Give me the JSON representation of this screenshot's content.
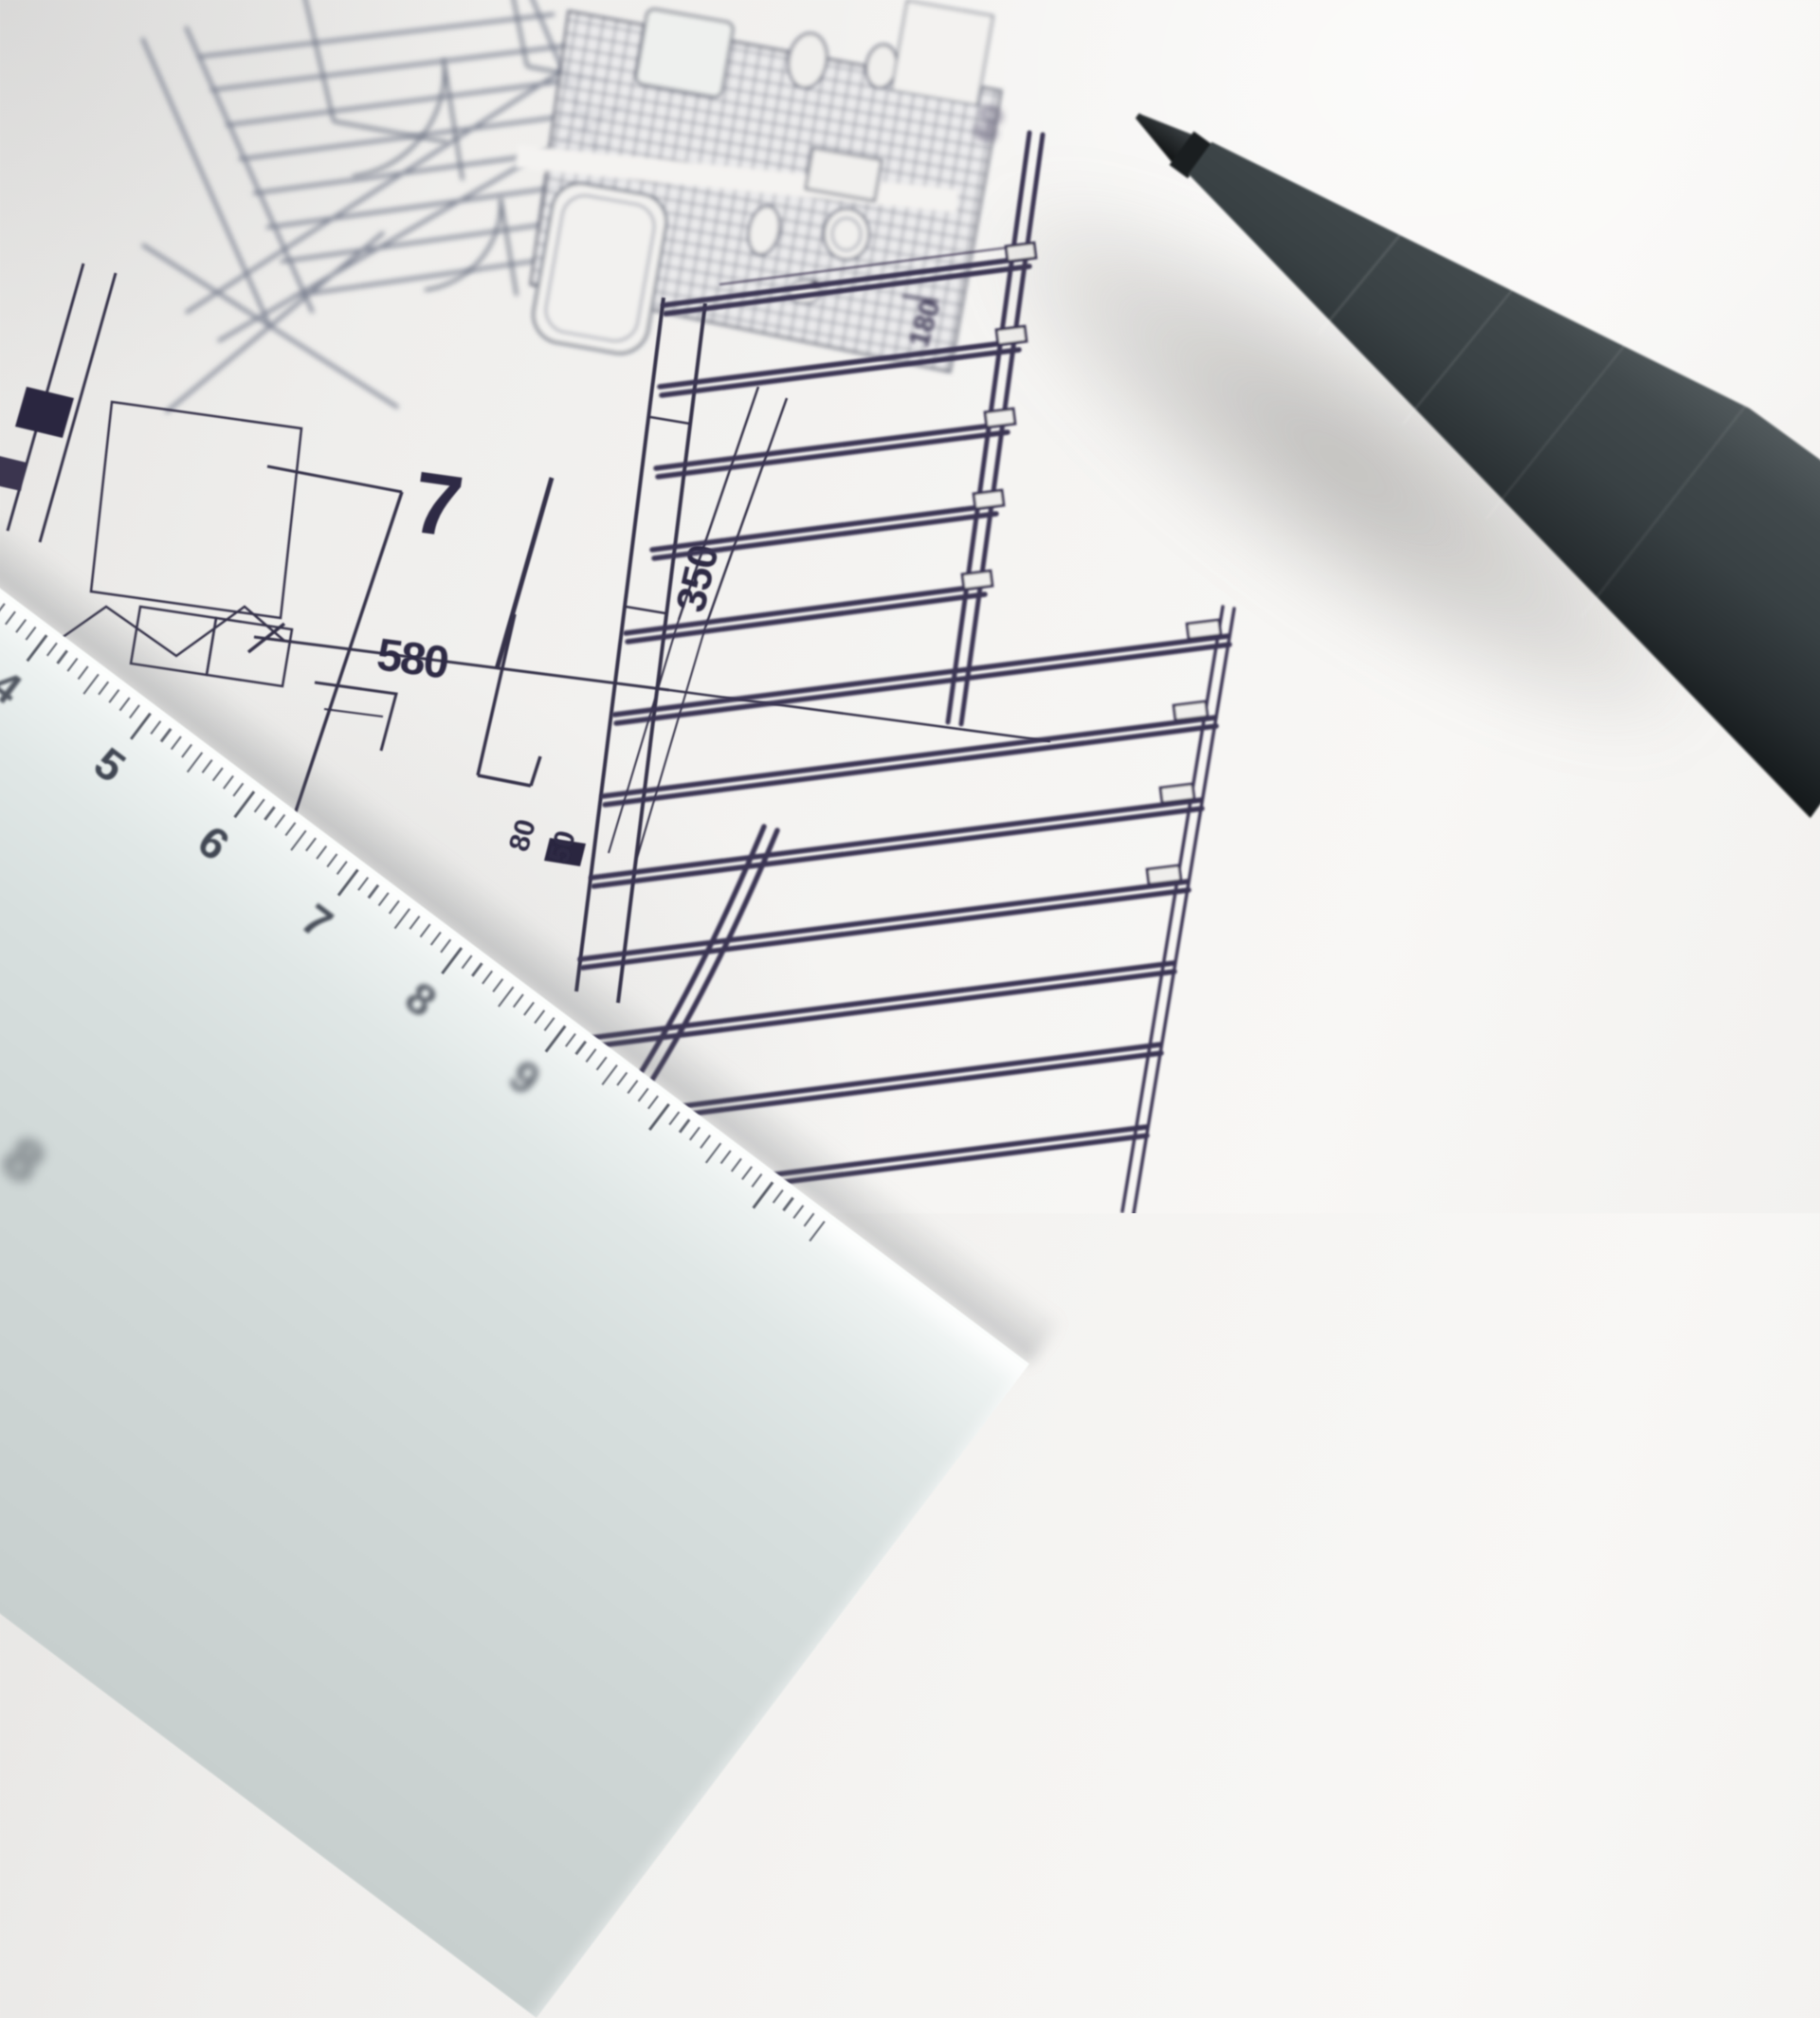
{
  "scene": {
    "description": "Close-up photograph of an architectural floor-plan print lying on a desk, with a pale transparent ruler across the lower-left corner and a dark grey fineliner pen lying diagonally across the upper-right",
    "objects": [
      "floor-plan-drawing",
      "ruler",
      "pen"
    ]
  },
  "floor_plan": {
    "room_number": "7",
    "dimensions": {
      "d580": "580",
      "d350": "350",
      "d80": "80",
      "d50": "50",
      "d180": "180",
      "d60": "60"
    }
  },
  "ruler": {
    "labels": [
      "4",
      "5",
      "6",
      "7",
      "8",
      "9"
    ],
    "corner_label": "8"
  },
  "colors": {
    "paper": "#f5f4f2",
    "ink": "#343049",
    "ink_blurred": "#6e7484",
    "ruler_body": "#d7dfde",
    "ruler_numerals": "#414753",
    "pen_body": "#3b4245",
    "pen_tip_metal": "#9aa0a3"
  }
}
